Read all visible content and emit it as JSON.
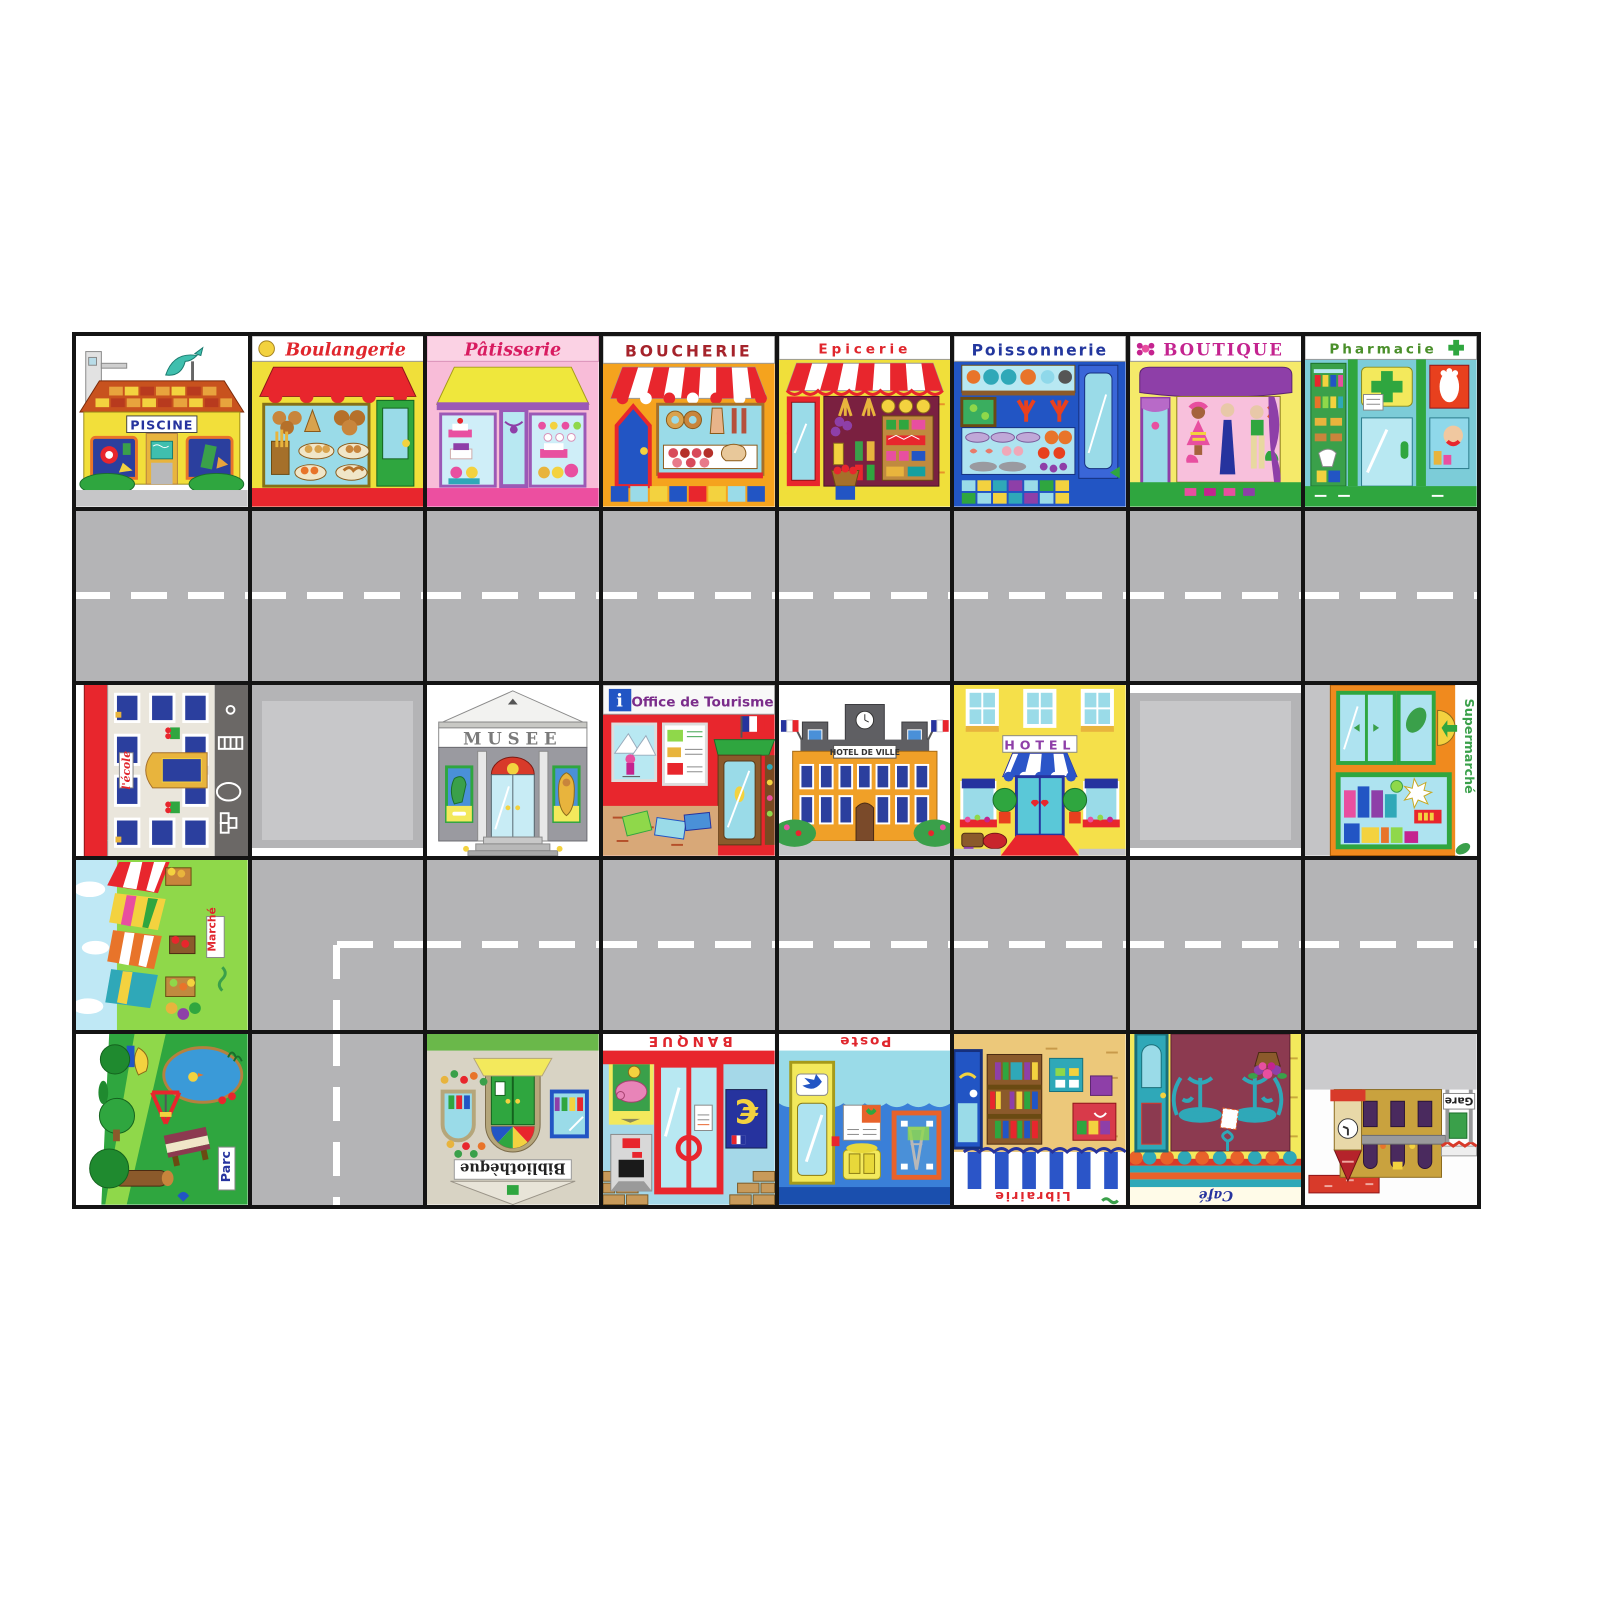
{
  "board": {
    "description": "French town play mat, 8 columns x 5 rows of tiles with grey roads",
    "grid": {
      "rows": 5,
      "cols": 8
    },
    "road_color": "#b4b4b6",
    "grid_line_color": "#141414",
    "dash_color": "#ffffff"
  },
  "tiles": {
    "piscine": {
      "label": "PISCINE",
      "label_color": "#26339e",
      "wall_color": "#f2df3a",
      "roof_color": "#c8521e",
      "rotation": 0
    },
    "boulangerie": {
      "label": "Boulangerie",
      "label_color": "#e0262d",
      "wall_color": "#f0df3a",
      "awning_color": "#e8262d",
      "rotation": 0
    },
    "patisserie": {
      "label": "Pâtisserie",
      "label_color": "#d81b60",
      "wall_color": "#f8bcd8",
      "awning_color": "#efe73c",
      "rotation": 0
    },
    "boucherie": {
      "label": "BOUCHERIE",
      "label_color": "#a5232b",
      "wall_color": "#f5a31e",
      "awning_color": "#e8262d",
      "rotation": 0
    },
    "epicerie": {
      "label": "Epicerie",
      "label_color": "#e0262d",
      "wall_color": "#f0df3a",
      "awning_color": "#e8262d",
      "rotation": 0
    },
    "poissonnerie": {
      "label": "Poissonnerie",
      "label_color": "#23379e",
      "wall_color": "#2255c4",
      "rotation": 0
    },
    "boutique": {
      "label": "BOUTIQUE",
      "label_color": "#c4238f",
      "wall_color": "#f5ea6a",
      "awning_color": "#8e3fa8",
      "rotation": 0
    },
    "pharmacie": {
      "label": "Pharmacie",
      "label_color": "#4a8f2a",
      "wall_color": "#7cccd8",
      "cross_color": "#2fa63f",
      "rotation": 0
    },
    "ecole": {
      "label": "l'école",
      "label_color": "#e0262d",
      "wall_color": "#eae6dc",
      "roof_color": "#e8262d",
      "rotation": -90
    },
    "musee": {
      "label": "MUSEE",
      "label_color": "#7a7a7a",
      "wall_color": "#9a9a9a",
      "rotation": 0
    },
    "office_tourisme": {
      "label": "Office de Tourisme",
      "info_glyph": "i",
      "label_color": "#7b2d8b",
      "wall_color": "#e8262d",
      "rotation": 0
    },
    "hotel_de_ville": {
      "label": "HOTEL DE VILLE",
      "label_color": "#333333",
      "wall_color": "#f0a028",
      "roof_color": "#5f5f63",
      "rotation": 0
    },
    "hotel": {
      "label": "HOTEL",
      "label_color": "#8e3fa8",
      "wall_color": "#f5e04a",
      "awning_color": "#2b55c8",
      "rotation": 0
    },
    "supermarche": {
      "label": "Supermarché",
      "label_color": "#3aa04a",
      "wall_color": "#f08a1e",
      "rotation": 90
    },
    "marche": {
      "label": "Marché",
      "label_color": "#e0262d",
      "ground_color": "#8fd84a",
      "rotation": -90
    },
    "parc": {
      "label": "Parc",
      "label_color": "#26339e",
      "ground_color": "#2fa63f",
      "rotation": -90
    },
    "bibliotheque": {
      "label": "Bibliothèque",
      "label_color": "#222222",
      "wall_color": "#d8d3c4",
      "door_color": "#2fa63f",
      "rotation": 180
    },
    "banque": {
      "label": "BANQUE",
      "euro_glyph": "€",
      "label_color": "#e0262d",
      "wall_color": "#a5d8e8",
      "rotation": 180
    },
    "poste": {
      "label": "Poste",
      "label_color": "#e0262d",
      "wall_color": "#3a7fd8",
      "rotation": 180
    },
    "librairie": {
      "label": "Librairie",
      "label_color": "#e0262d",
      "wall_color": "#ecc87a",
      "awning_color": "#2b55c8",
      "rotation": 180
    },
    "cafe": {
      "label": "Café",
      "label_color": "#26339e",
      "wall_color": "#8c3a50",
      "furniture_color": "#2fa8b8",
      "rotation": 180
    },
    "gare": {
      "label": "Gare",
      "label_color": "#222222",
      "wall_color": "#c9a23e",
      "roof_color": "#d83a2a",
      "rotation": 180
    }
  },
  "roads": {
    "row2": "horizontal road, white dashed centre line across all 8 tiles",
    "row4": "horizontal road tiles 2-8, dashed line turns down at tile 2",
    "row5_tile2": "vertical road, white dashed centre line",
    "empty_lots": [
      "row3 tile2",
      "row3 tile7"
    ]
  }
}
